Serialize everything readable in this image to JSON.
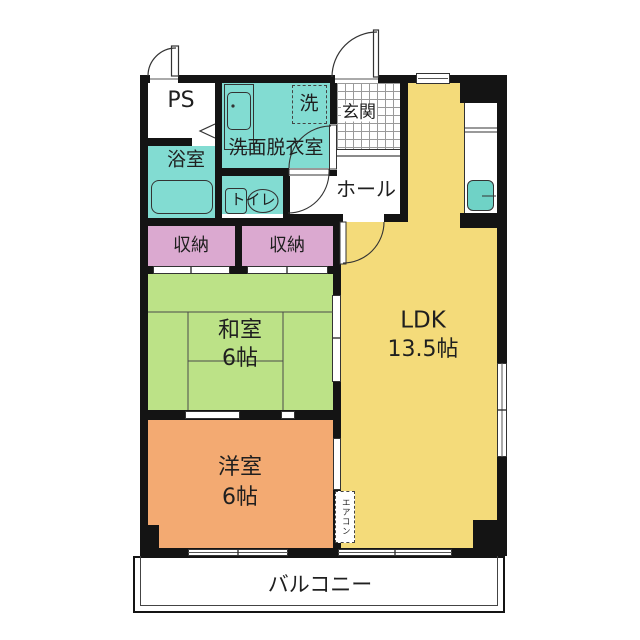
{
  "title": "2LDK apartment floor plan",
  "rooms": {
    "ps": {
      "label": "PS"
    },
    "bathroom": {
      "label": "浴室"
    },
    "washroom": {
      "label": "洗面脱衣室"
    },
    "washer": {
      "label": "洗"
    },
    "entrance": {
      "label": "玄関"
    },
    "hall": {
      "label": "ホール"
    },
    "toilet": {
      "label": "トイレ"
    },
    "closet_left": {
      "label": "収納"
    },
    "closet_right": {
      "label": "収納"
    },
    "japanese_room": {
      "label": "和室",
      "size": "6帖"
    },
    "western_room": {
      "label": "洋室",
      "size": "6帖"
    },
    "ldk": {
      "label": "LDK",
      "size": "13.5帖"
    },
    "balcony": {
      "label": "バルコニー"
    }
  },
  "annotations": {
    "aircon": {
      "label": "エアコン"
    }
  },
  "colors": {
    "wall": "#141414",
    "wet_area_teal": "#82dcd2",
    "closet_pink": "#dba9d0",
    "tatami_green": "#bce287",
    "ldk_yellow": "#f4db7a",
    "western_orange": "#f3aa72",
    "sink_teal": "#6fd2c6"
  }
}
